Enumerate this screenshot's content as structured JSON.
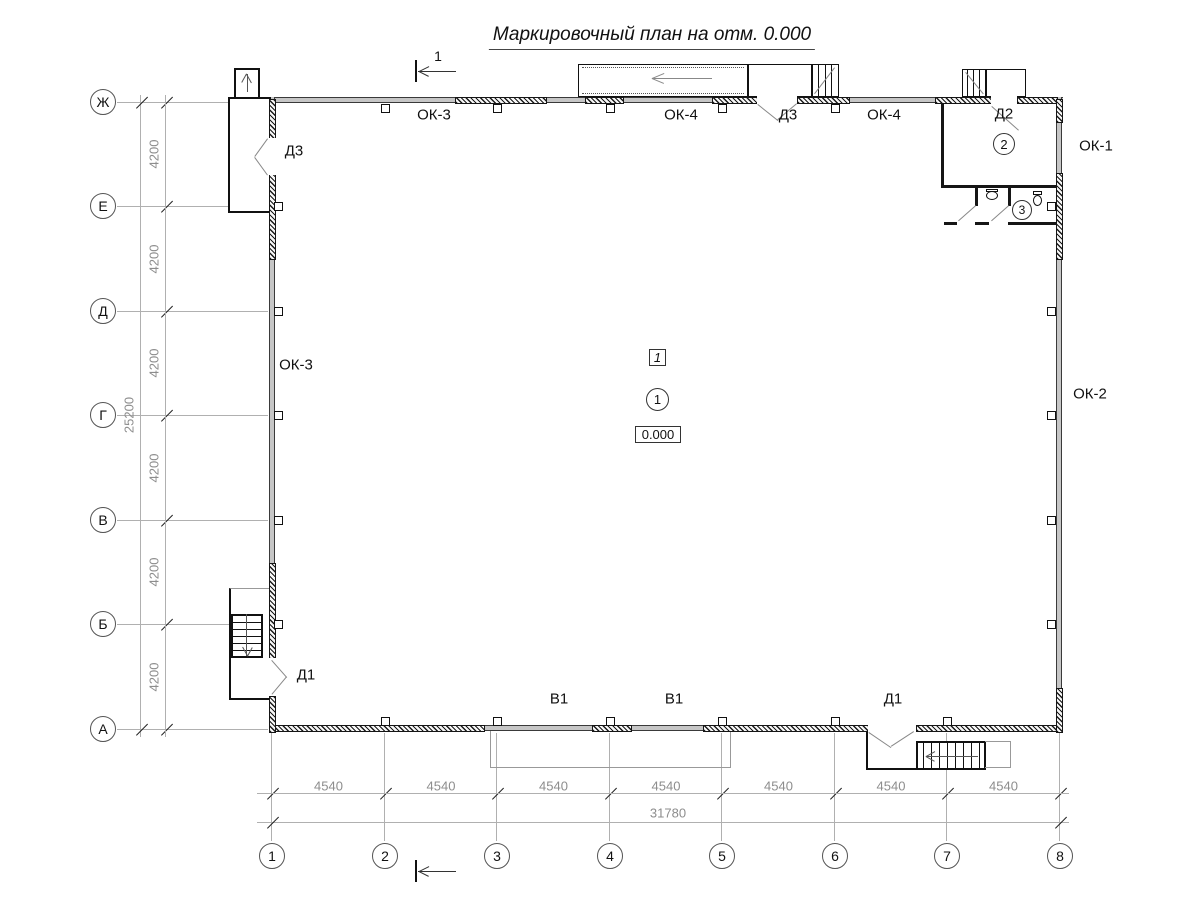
{
  "title": "Маркировочный план на отм. 0.000",
  "section_mark": {
    "number": "1"
  },
  "axes": {
    "vertical": [
      "Ж",
      "Е",
      "Д",
      "Г",
      "В",
      "Б",
      "А"
    ],
    "horizontal": [
      "1",
      "2",
      "3",
      "4",
      "5",
      "6",
      "7",
      "8"
    ]
  },
  "dimensions": {
    "vertical_segment": "4200",
    "vertical_total": "25200",
    "horizontal_segment": "4540",
    "horizontal_total": "31780"
  },
  "marks": {
    "ok1": "ОК-1",
    "ok2": "ОК-2",
    "ok3": "ОК-3",
    "ok4": "ОК-4",
    "d1": "Д1",
    "d2": "Д2",
    "d3": "Д3",
    "v1": "В1"
  },
  "rooms": {
    "hall_tag": "1",
    "hall_number": "1",
    "room2_number": "2",
    "room3_number": "3",
    "elevation": "0.000"
  }
}
